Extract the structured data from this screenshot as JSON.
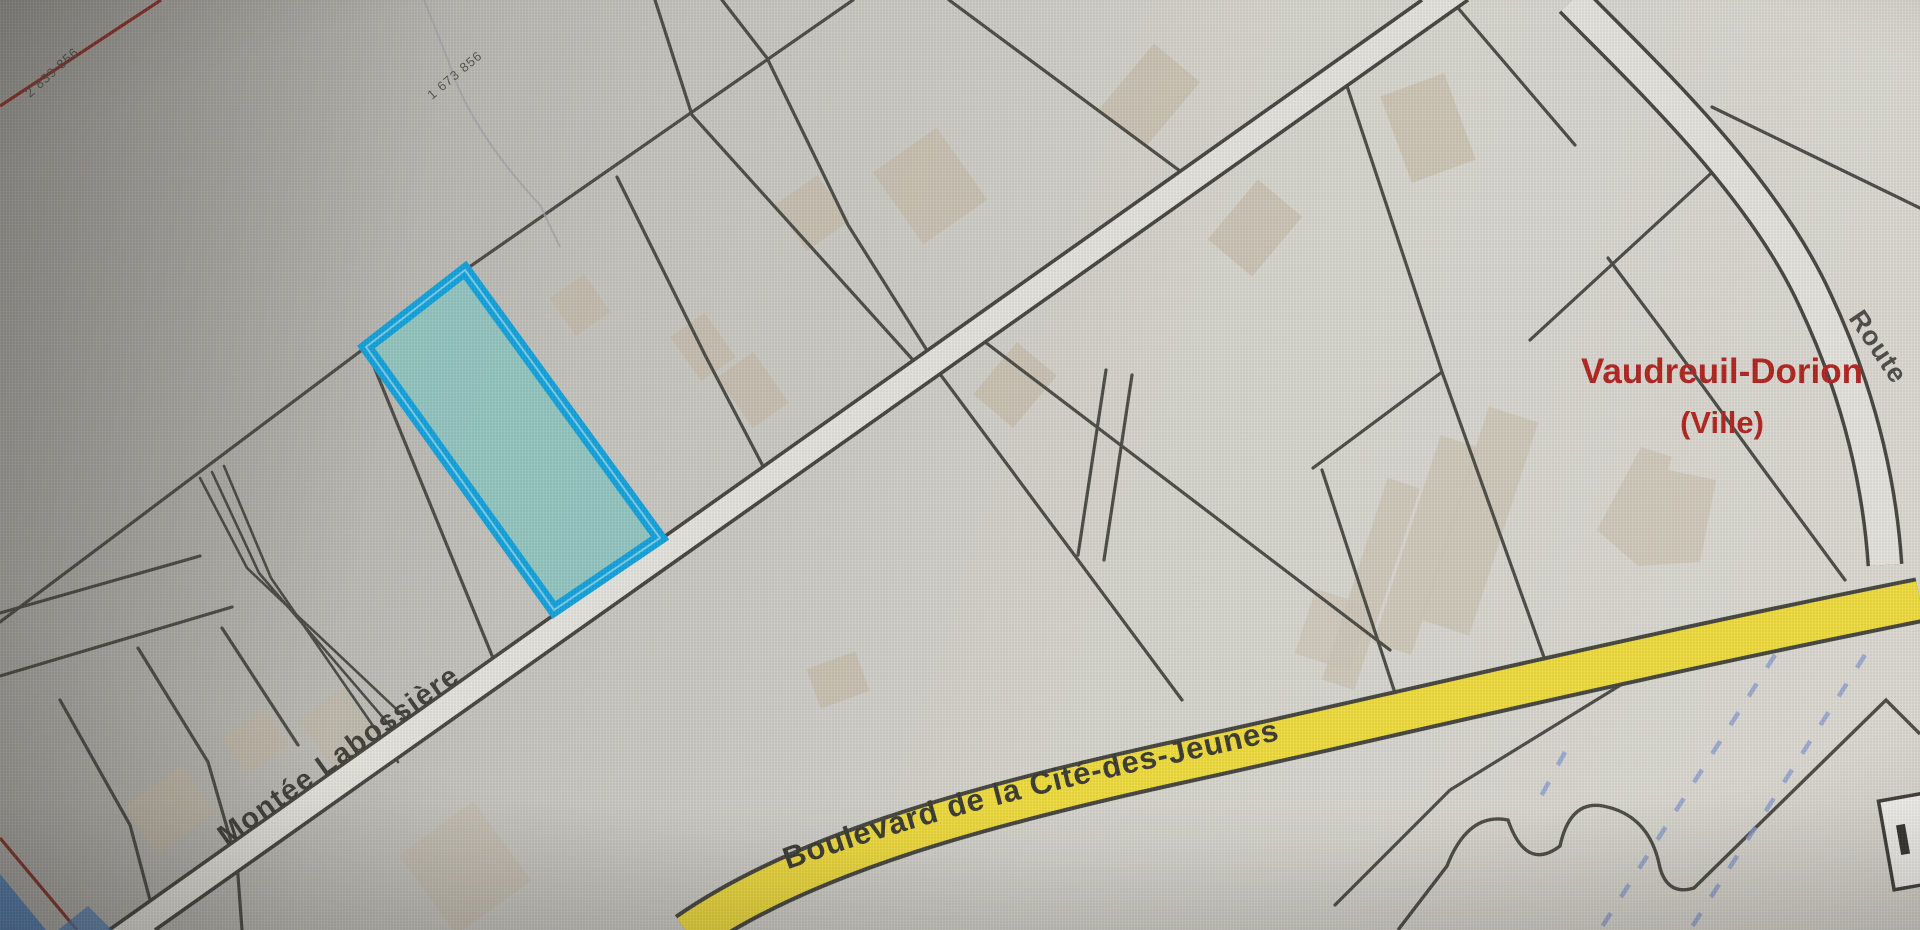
{
  "map": {
    "municipality": {
      "line1": "Vaudreuil-Dorion",
      "line2": "(Ville)",
      "color": "#b2231e"
    },
    "streets": {
      "montee": "Montée Labossière",
      "boulevard": "Boulevard de la Cité-des-Jeunes",
      "route": "Route"
    },
    "lot_numbers": {
      "num1": "2 839 856",
      "num2": "1 673 856"
    },
    "highlighted_parcel": {
      "fill": "#8fc7c1",
      "stroke": "#12a3dd"
    },
    "road_colors": {
      "boulevard_fill": "#f1dd3d",
      "road_fill": "#e6e4dd",
      "casing": "#45453f"
    },
    "hydro_dash_color": "#8d9fd0"
  }
}
